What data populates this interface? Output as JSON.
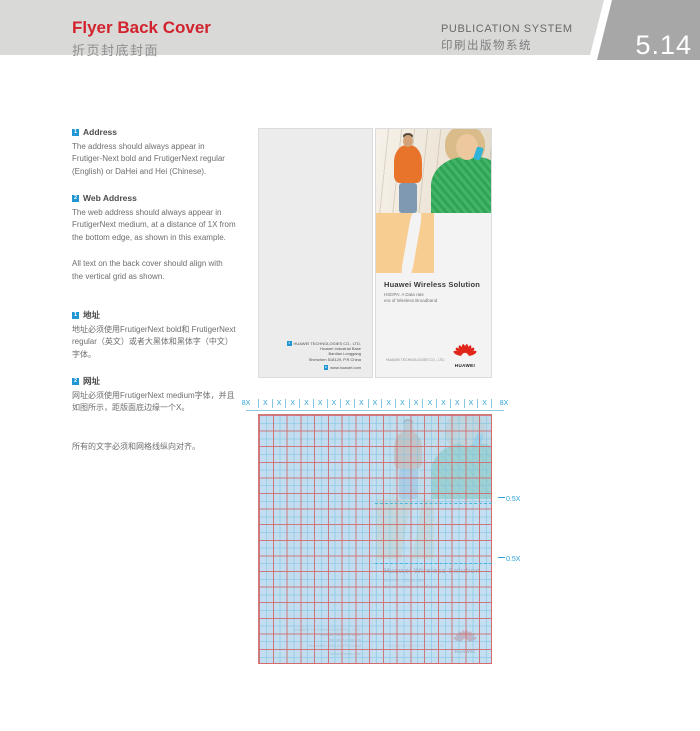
{
  "header": {
    "title": "Flyer Back Cover",
    "title_cn": "折页封底封面",
    "system": "PUBLICATION SYSTEM",
    "system_cn": "印刷出版物系统",
    "page_number": "5.14",
    "accent_color": "#d2232e"
  },
  "sidebar": {
    "marker_color": "#2196d3",
    "sections": [
      {
        "num": "1",
        "heading": "Address",
        "body": "The address should always appear in Frutiger-Next bold and FrutigerNext regular (English) or DaHei and Hei (Chinese)."
      },
      {
        "num": "2",
        "heading": "Web Address",
        "body": "The web address should always appear in FrutigerNext medium, at a distance of 1X from the bottom edge, as shown in this example."
      }
    ],
    "note": "All text on the back cover should align with the vertical grid as shown.",
    "sections_cn": [
      {
        "num": "1",
        "heading": "地址",
        "body": "地址必须使用FrutigerNext bold和 FrutigerNext regular（英文）或者大黑体和黑体字（中文）字体。"
      },
      {
        "num": "2",
        "heading": "网址",
        "body": "网址必须使用FrutigerNext medium字体，并且如图所示，距版面底边缘一个X。"
      }
    ],
    "note_cn": "所有的文字必须和网格线纵向对齐。"
  },
  "flyer": {
    "title": "Huawei Wireless Solution",
    "subtitle_line1": "HSDPA: A Data rate",
    "subtitle_line2": "era of Wireless Broadband",
    "callout_address_num": "1",
    "callout_web_num": "2",
    "address_lines": [
      "HUAWEI TECHNOLOGIES CO., LTD.",
      "Huawei Industrial Base",
      "Bantian Longgang",
      "Shenzhen 518129, P.R.China"
    ],
    "web_address": "www.huawei.com",
    "footer_company": "HUAWEI TECHNOLOGIES CO., LTD.",
    "logo_text": "HUAWEI",
    "logo_color": "#e1251b",
    "orange_color": "#f8cd92"
  },
  "grid": {
    "margin_label_left": "8X",
    "margin_label_right": "8X",
    "unit_label": "X",
    "unit_count": 17,
    "spacing_labels": [
      "0.5X",
      "0.5X"
    ],
    "label_color": "#2ea3d6"
  }
}
